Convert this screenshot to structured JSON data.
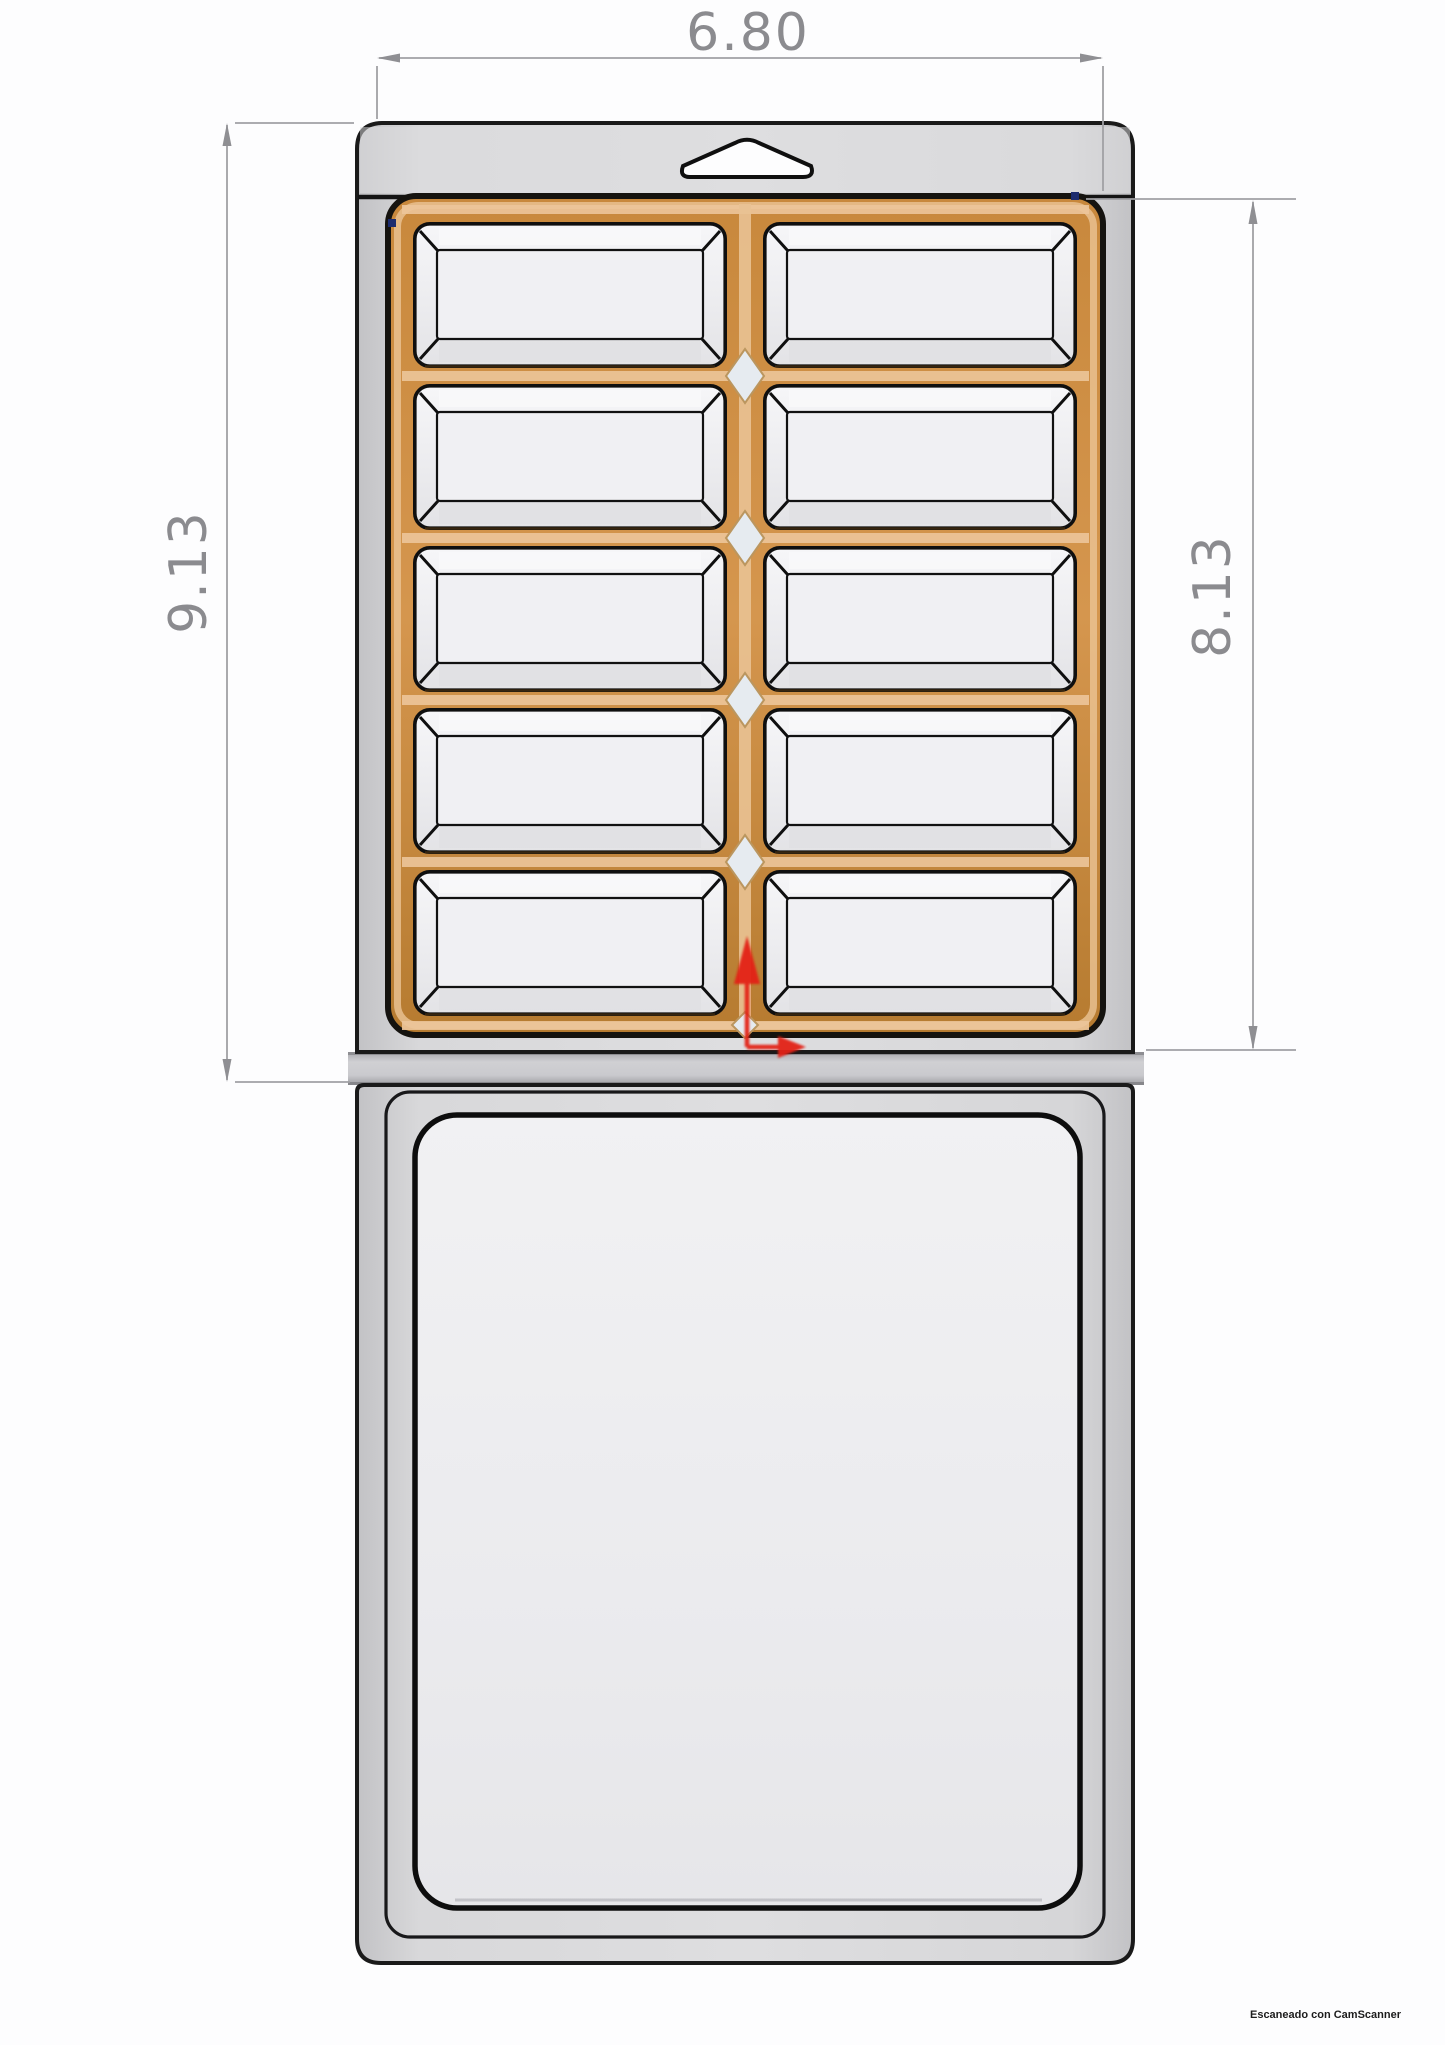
{
  "document": {
    "watermark": "Escaneado con CamScanner"
  },
  "drawing": {
    "dimensions": {
      "width": "6.80",
      "overall_height": "9.13",
      "blister_height": "8.13"
    },
    "pocket_grid": {
      "rows": 5,
      "columns": 2,
      "pocket_count": 10
    },
    "colors": {
      "card_gray": "#d6d6d9",
      "flange_orange": "#cd8d44",
      "axis_red": "#e32017",
      "dimension_gray": "#8b8b8f",
      "vertex_navy": "#1c2b6e"
    }
  }
}
